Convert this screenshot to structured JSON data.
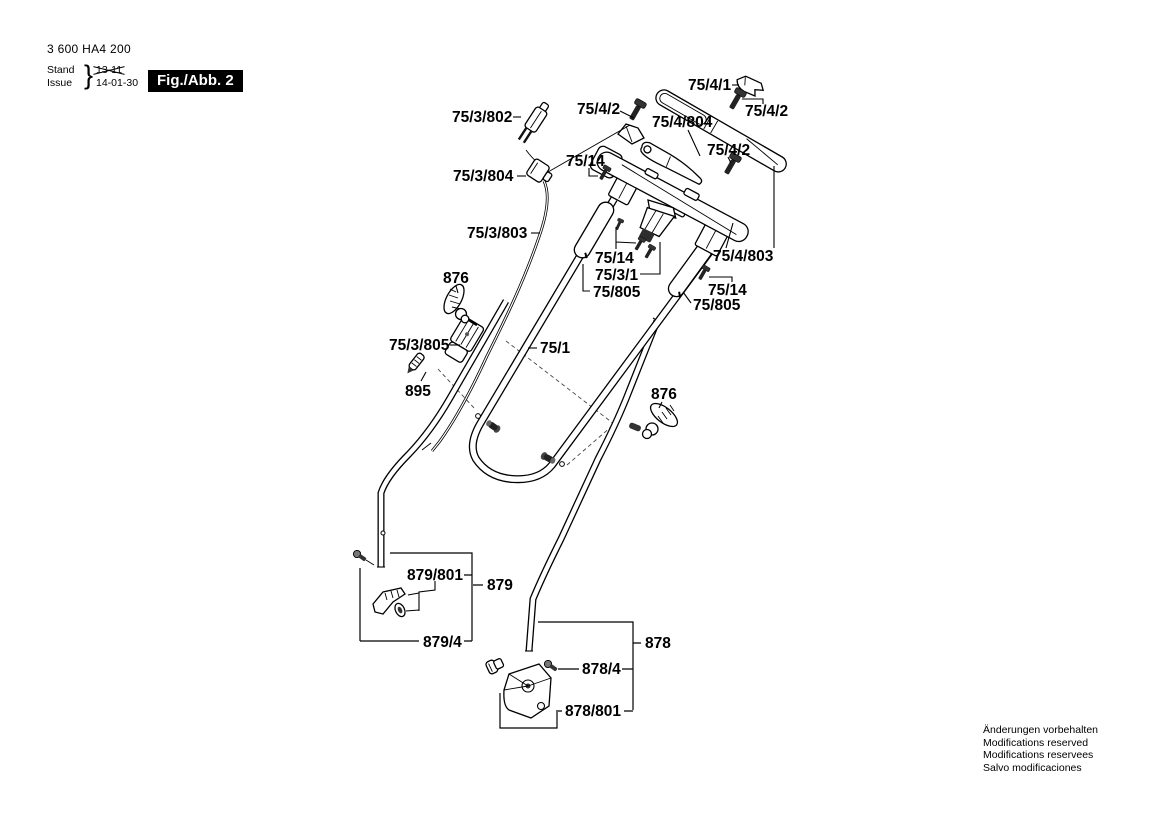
{
  "header": {
    "part_number": "3 600 HA4 200",
    "stand_label": "Stand",
    "issue_label": "Issue",
    "brace": "}",
    "stand_value": "13-11",
    "issue_value": "14-01-30",
    "figure_tag": "Fig./Abb. 2"
  },
  "footer": {
    "notice_lines": [
      "Änderungen vorbehalten",
      "Modifications reserved",
      "Modifications reservees",
      "Salvo modificaciones"
    ]
  },
  "diagram": {
    "type": "exploded-parts-diagram",
    "part_labels": [
      "75/4/1",
      "75/4/2",
      "75/4/804",
      "75/4/2",
      "75/4/2",
      "75/3/802",
      "75/14",
      "75/3/804",
      "75/3/803",
      "75/14",
      "75/3/1",
      "75/805",
      "75/4/803",
      "75/14",
      "75/805",
      "876",
      "75/3/805",
      "75/1",
      "895",
      "876",
      "879/801",
      "879",
      "879/4",
      "878",
      "878/4",
      "878/801"
    ]
  }
}
